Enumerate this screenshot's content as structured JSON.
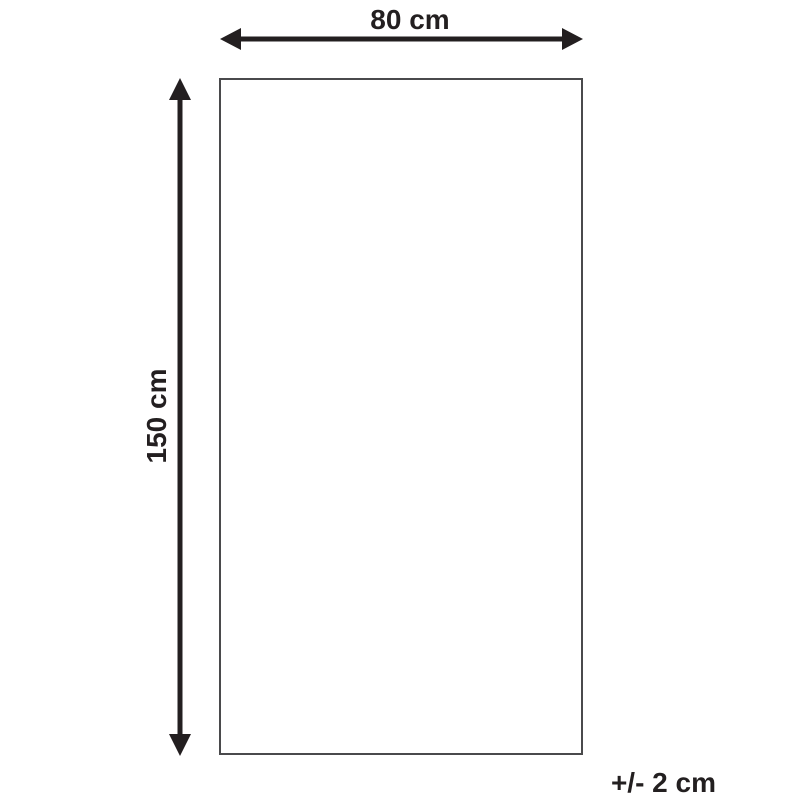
{
  "diagram": {
    "type": "product-dimension-diagram",
    "width_label": "80 cm",
    "height_label": "150 cm",
    "tolerance_label": "+/- 2 cm",
    "colors": {
      "arrow": "#231f20",
      "rectangle_border": "#4a4a4c",
      "background": "#ffffff"
    }
  }
}
